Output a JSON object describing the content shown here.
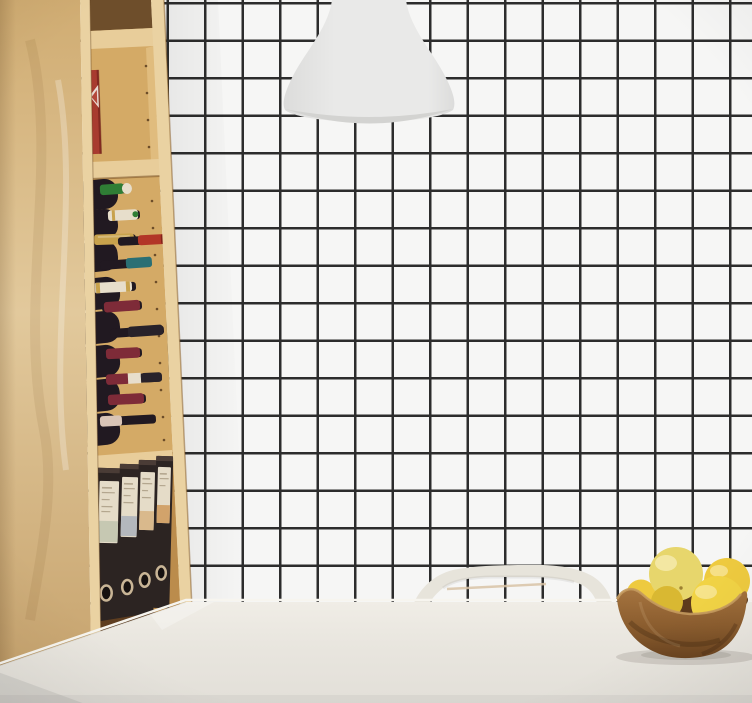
{
  "scene": {
    "title": "Dining corner render: birch bookshelf with wine rack and binders, grid wallpaper, pendant lamp, white table with chair and bowl of lemons",
    "objects": {
      "wallpaper": {
        "name": "square-grid-wallpaper",
        "pattern": "black grid on white"
      },
      "pendant_lamp": {
        "name": "white-pendant-lamp"
      },
      "bookshelf": {
        "name": "birch-bookshelf",
        "compartments": [
          "top shelf with red book",
          "wine rack",
          "lever-arch binders"
        ],
        "red_book_count": 1,
        "wine_bottle_count": 12,
        "binder_count": 4
      },
      "table": {
        "name": "white-dining-table"
      },
      "chair": {
        "name": "white-chair-backrest"
      },
      "fruit_bowl": {
        "name": "carved-wooden-bowl",
        "fruit": "lemons",
        "visible_fruit_count": 5
      }
    },
    "wine_capsule_colors": [
      "green",
      "cream",
      "gold",
      "red",
      "teal",
      "cream-gold",
      "maroon",
      "dark",
      "maroon",
      "cream-band-dark",
      "maroon",
      "blush-dark"
    ]
  },
  "palette": {
    "wall_bg": "#f6f6f5",
    "grid_line": "#2c2c2c",
    "lamp_body": "#e9e9e8",
    "lamp_body_shade": "#dcdcdb",
    "lamp_rim": "#d3d3d1",
    "wood_panel_top": "#d0ac72",
    "wood_panel_mid": "#e2c99c",
    "wood_panel_bottom": "#c6a26c",
    "wood_edge": "#ead2a2",
    "wood_back": "#d4aa66",
    "wood_back_shadow": "#6e4e2b",
    "wood_divider": "#e8cd9a",
    "wood_inner_wall": "#e0bc7e",
    "wood_bottom_shadow": "#5f3e20",
    "wood_bottom_board": "#b98e52",
    "binder_shelf_back": "#bb8c4c",
    "book_red": "#a83b2f",
    "book_label": "#e9dad2",
    "bottle_glass": "#211921",
    "capsule_green": "#2f7d35",
    "capsule_cream": "#e7decb",
    "capsule_gold": "#c8a24c",
    "capsule_red": "#b23527",
    "capsule_teal": "#2a6f74",
    "capsule_maroon": "#7e2b38",
    "capsule_dark": "#28222a",
    "capsule_blush": "#d9c4b6",
    "binder_body": "#2c2422",
    "binder_top": "#4a3c36",
    "binder_label": "#e5dcc8",
    "binder_label_line": "#b3a68e",
    "binder_block_sage": "#c6c8b2",
    "binder_block_gray": "#b4b8bd",
    "binder_block_tan": "#d9b98c",
    "binder_block_orange": "#d2a36b",
    "binder_ring": "#c9b596",
    "binder_hole": "#161110",
    "chair_body": "#e7e4db",
    "chair_rail": "#d8c3a6",
    "table_top": "#f0ede6",
    "table_mid": "#e9e6df",
    "table_bottom": "#e2dfd8",
    "table_edge_highlight": "#f7f5ef",
    "bowl_top": "#a5743f",
    "bowl_mid": "#8a5c2e",
    "bowl_bottom": "#6a4420",
    "bowl_rim": "#c49a5e",
    "bowl_interior": "#5e3b1c",
    "fruit_pale": "#e7d66c",
    "fruit_yellow": "#eeca3f",
    "fruit_bright": "#f1d345",
    "fruit_deep": "#d9b832",
    "fruit_highlight": "#fdf6cf"
  }
}
